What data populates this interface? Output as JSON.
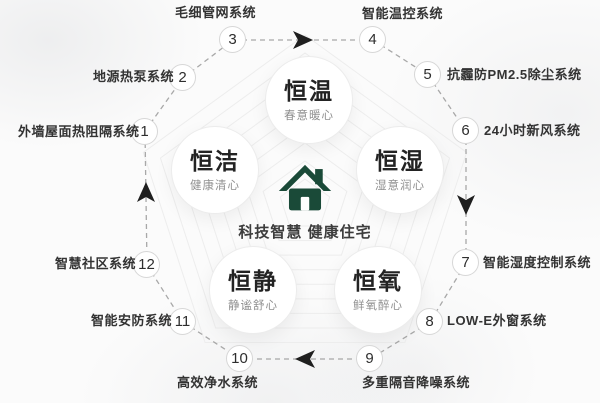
{
  "colors": {
    "house_green": "#1a4a38",
    "connector_gray": "#a8a8a8",
    "arrow_black": "#1f1f1f",
    "background": "#fbfbfb"
  },
  "icons": {
    "center": "house-icon"
  },
  "center": {
    "tagline": "科技智慧 健康住宅"
  },
  "concepts": [
    {
      "title": "恒温",
      "subtitle": "春意暖心"
    },
    {
      "title": "恒洁",
      "subtitle": "健康清心"
    },
    {
      "title": "恒湿",
      "subtitle": "湿意润心"
    },
    {
      "title": "恒静",
      "subtitle": "静谧舒心"
    },
    {
      "title": "恒氧",
      "subtitle": "鲜氧醉心"
    }
  ],
  "systems": [
    {
      "num": "1",
      "label": "外墙屋面热阻隔系统"
    },
    {
      "num": "2",
      "label": "地源热泵系统"
    },
    {
      "num": "3",
      "label": "毛细管网系统"
    },
    {
      "num": "4",
      "label": "智能温控系统"
    },
    {
      "num": "5",
      "label": "抗霾防PM2.5除尘系统"
    },
    {
      "num": "6",
      "label": "24小时新风系统"
    },
    {
      "num": "7",
      "label": "智能湿度控制系统"
    },
    {
      "num": "8",
      "label": "LOW-E外窗系统"
    },
    {
      "num": "9",
      "label": "多重隔音降噪系统"
    },
    {
      "num": "10",
      "label": "高效净水系统"
    },
    {
      "num": "11",
      "label": "智能安防系统"
    },
    {
      "num": "12",
      "label": "智慧社区系统"
    }
  ]
}
